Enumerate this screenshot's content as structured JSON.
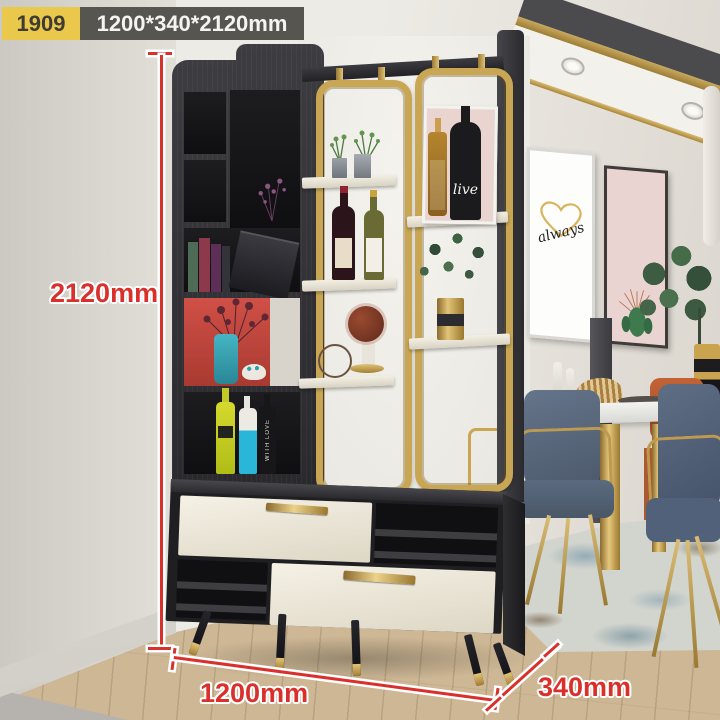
{
  "product_label": {
    "model": "1909",
    "size": "1200*340*2120mm"
  },
  "dims": {
    "height": "2120mm",
    "width": "1200mm",
    "depth": "340mm"
  },
  "art": {
    "word": "always"
  },
  "poster": {
    "word": "live"
  },
  "bottle": {
    "word": "WITH LOVE"
  },
  "colors": {
    "annotation_red": "#d9302c",
    "badge_yellow": "#e9c84c",
    "badge_dark": "#57554f",
    "gold": "#c9a654",
    "wood_dark": "#2e2e31",
    "drawer_cream": "#efe9da",
    "red_compartment": "#cc4a42",
    "wall": "#e9e6e0",
    "floor_oak": "#cdb795",
    "chair_blue": "#5a6878",
    "chair_orange": "#b55a31"
  }
}
